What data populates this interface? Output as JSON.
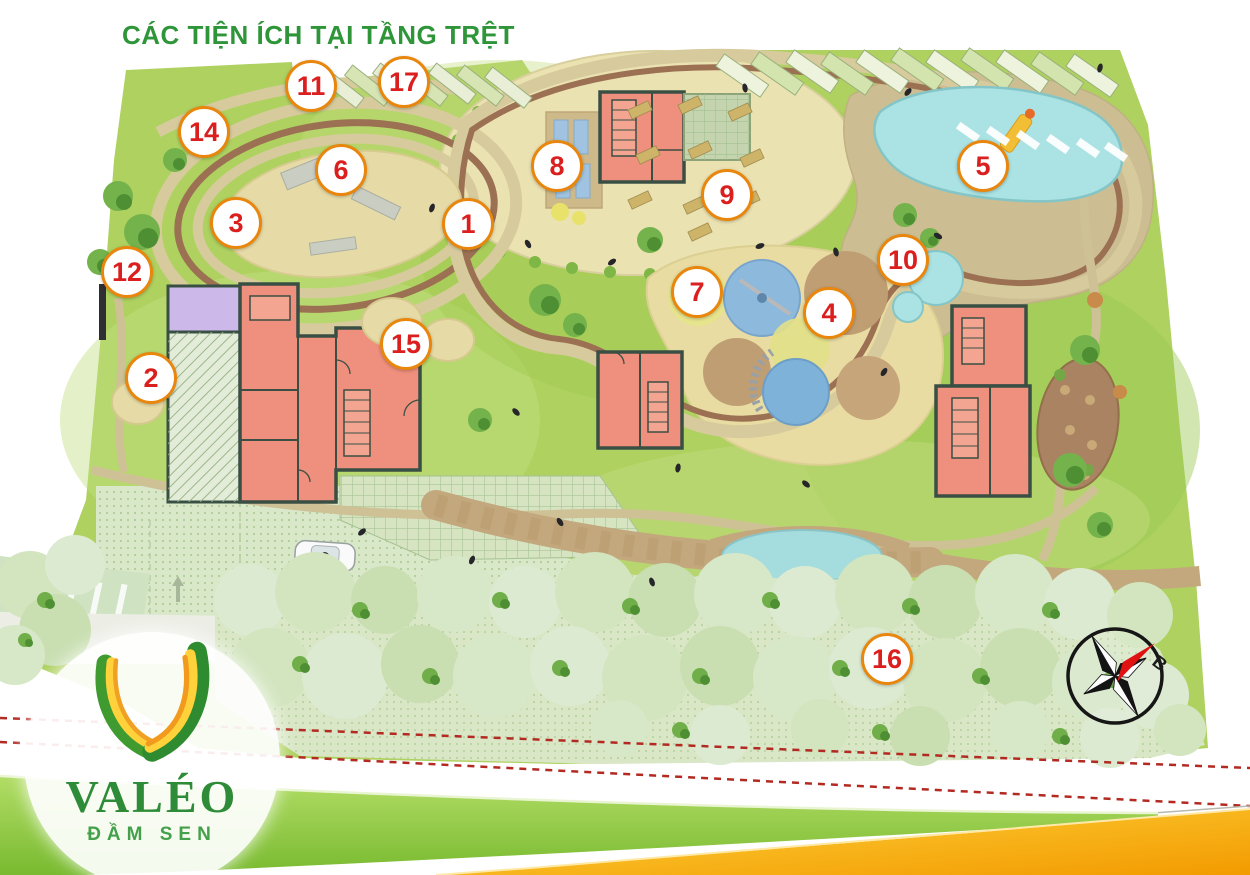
{
  "title": "CÁC TIỆN ÍCH TẠI TẦNG TRỆT",
  "logo": {
    "brand": "VALÉO",
    "subtitle": "ĐẦM SEN"
  },
  "compass": {
    "north_label": "B"
  },
  "legend_markers": [
    {
      "number": "1",
      "x": 468,
      "y": 224
    },
    {
      "number": "2",
      "x": 151,
      "y": 378
    },
    {
      "number": "3",
      "x": 236,
      "y": 223
    },
    {
      "number": "4",
      "x": 829,
      "y": 313
    },
    {
      "number": "5",
      "x": 983,
      "y": 166
    },
    {
      "number": "6",
      "x": 341,
      "y": 170
    },
    {
      "number": "7",
      "x": 697,
      "y": 292
    },
    {
      "number": "8",
      "x": 557,
      "y": 166
    },
    {
      "number": "9",
      "x": 727,
      "y": 195
    },
    {
      "number": "10",
      "x": 903,
      "y": 260
    },
    {
      "number": "11",
      "x": 311,
      "y": 86
    },
    {
      "number": "12",
      "x": 127,
      "y": 272
    },
    {
      "number": "14",
      "x": 204,
      "y": 132
    },
    {
      "number": "15",
      "x": 406,
      "y": 344
    },
    {
      "number": "16",
      "x": 887,
      "y": 659
    },
    {
      "number": "17",
      "x": 404,
      "y": 82
    }
  ],
  "colors": {
    "title_green": "#2e9639",
    "marker_border": "#e8860d",
    "marker_number": "#db1f1e",
    "pool_water": "#abe2e3",
    "building_fill": "#ef8f7d",
    "ribbon_green": "#7cbc33",
    "ribbon_yellow": "#f6a700",
    "boundary_dash": "#b32a22"
  }
}
